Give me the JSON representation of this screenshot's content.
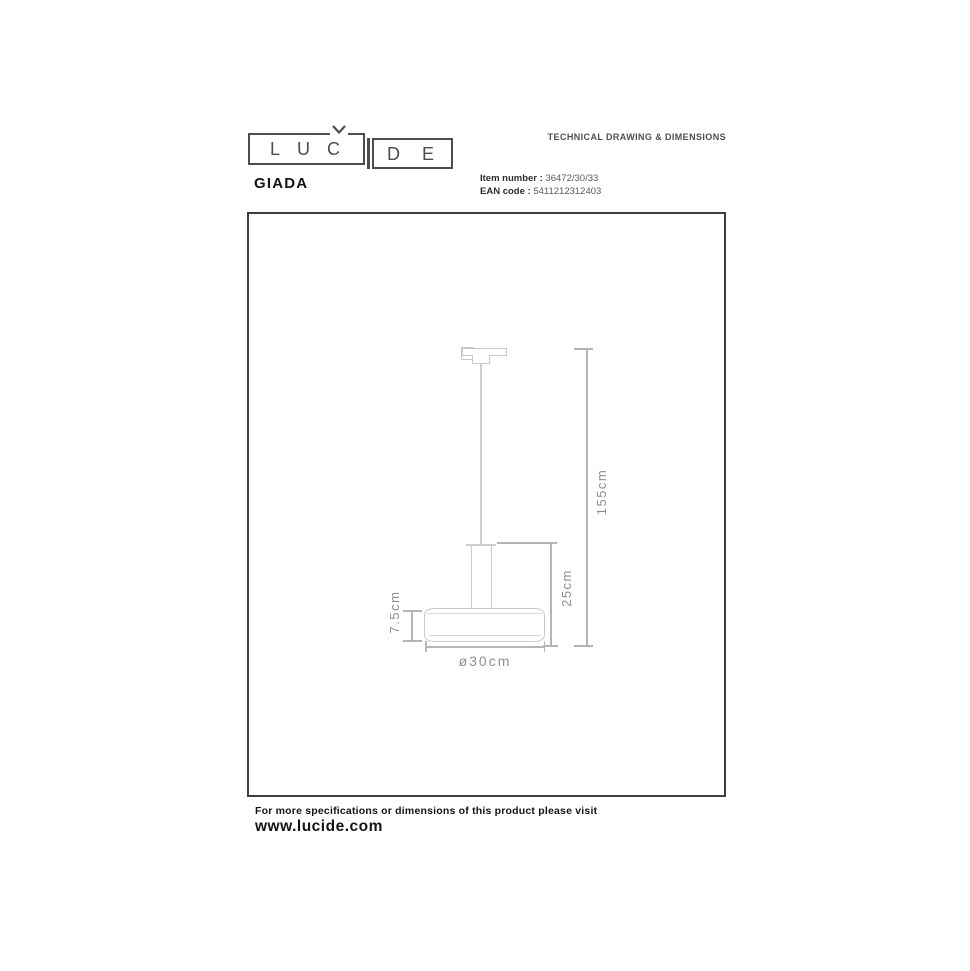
{
  "brand": {
    "name": "LUCIDE",
    "logo_left": "LUC",
    "logo_right": "DE"
  },
  "header": {
    "doc_type": "TECHNICAL DRAWING & DIMENSIONS",
    "product_name": "GIADA",
    "item_number_label": "Item number :",
    "item_number": "36472/30/33",
    "ean_label": "EAN code :",
    "ean": "5411212312403"
  },
  "drawing": {
    "type": "pendant-lamp-technical-drawing",
    "dimensions": {
      "total_height": "155cm",
      "fixture_height": "25cm",
      "shade_height": "7.5cm",
      "diameter": "ø30cm"
    }
  },
  "footer": {
    "note": "For more specifications or dimensions of this product please visit",
    "website": "www.lucide.com"
  },
  "colors": {
    "outline": "#c9c9c9",
    "dimension_line": "#b5b5b5",
    "dimension_text": "#8f8f8f",
    "frame": "#3e3e3e",
    "text_dark": "#141414"
  }
}
